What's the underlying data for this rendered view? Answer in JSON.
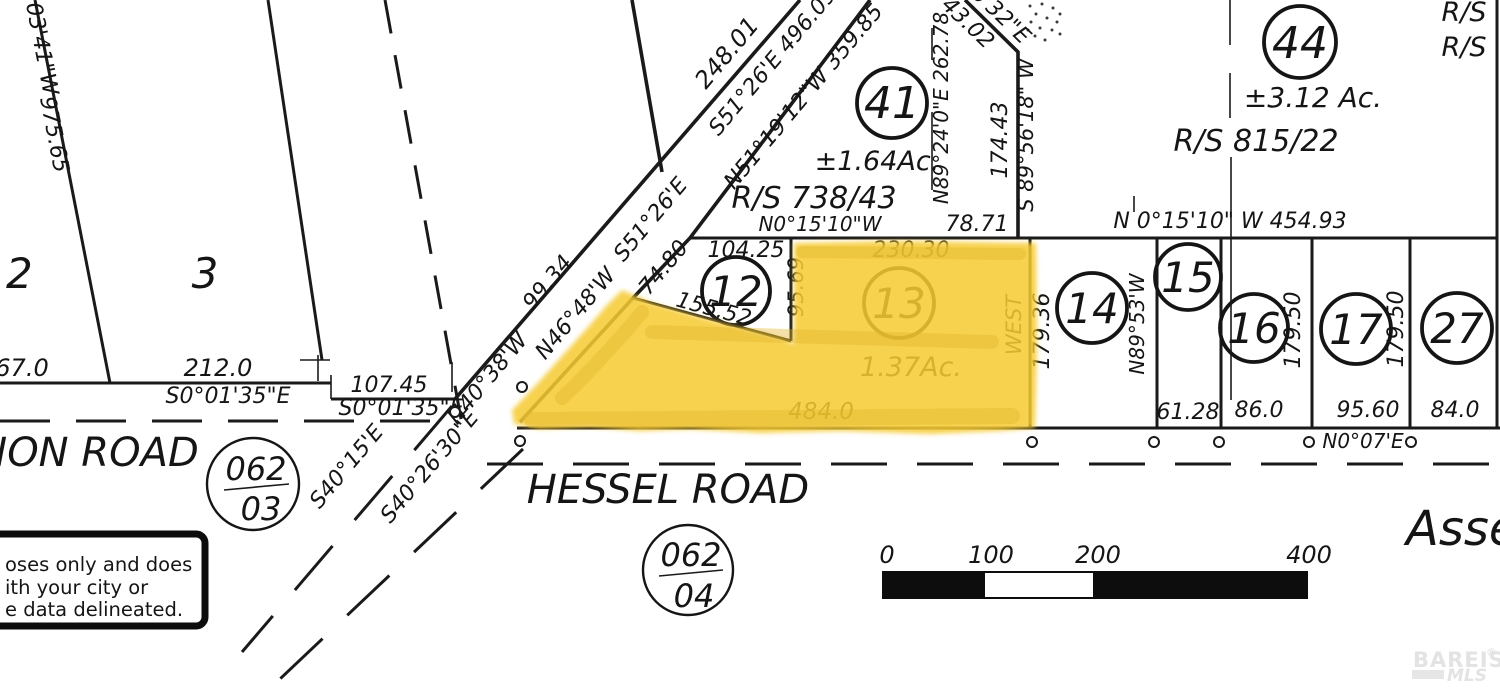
{
  "highlight": {
    "parcel": "13",
    "color": "#F6CB33",
    "streak_color": "#E2B62A"
  },
  "parcels": {
    "p2": "2",
    "p3": "3",
    "p12": "12",
    "p13": "13",
    "p14": "14",
    "p15": "15",
    "p16": "16",
    "p17": "17",
    "p27": "27",
    "p41": "41",
    "p44": "44"
  },
  "areas": {
    "a41": "±1.64Ac.",
    "a44": "±3.12  Ac.",
    "a13": "1.37Ac."
  },
  "survey_refs": {
    "rs41": "R/S  738/43",
    "rs44": "R/S  815/22",
    "rsTop1": "R/S",
    "rsTop2": "R/S"
  },
  "dimensions": {
    "d975_65": "975.65",
    "d67_0": "67.0",
    "d212_0": "212.0",
    "d107_45": "107.45",
    "d248_01": "248.01",
    "d99_34": "99.34",
    "d74_80": "74.80",
    "d104_25": "104.25",
    "d95_69": "95.69",
    "d155_52": "155.52",
    "d230_30": "230.30",
    "d484_0": "484.0",
    "d78_71": "78.71",
    "d43_02": "43.02",
    "d174_43": "174.43",
    "d179_36": "179.36",
    "d61_28": "61.28",
    "d86_0": "86.0",
    "d179_50a": "179.50",
    "d95_60": "95.60",
    "d179_50b": "179.50",
    "d84_0": "84.0"
  },
  "bearings": {
    "b0341": "03'41\"W",
    "bS001_35a": "S0°01'35\"E",
    "bS001_35b": "S0°01'35\"E",
    "bS51_26_496": "S51°26'E  496.09",
    "bN51_19": "N51°19'12\"W  359.85",
    "bS51_26": "S51°26'E",
    "bN46_48": "N46°48'W",
    "bN40_38": "N40°38'W",
    "bS40_15": "S40°15'E",
    "bS40_26": "S40°26'30\"E",
    "bN015_10": "N0°15'10\"W",
    "bN89_24": "N89°24'0\"E  262.78",
    "b6_32": "6'32\"E",
    "bS89_56": "S 89°56'18\" W",
    "bN015_454": "N  0°15'10\"  W  454.93",
    "bWEST": "WEST",
    "bN89_53": "N89°53'W",
    "bN0_07": "N0°07'E"
  },
  "roads": {
    "hessel": "HESSEL  ROAD",
    "non": "NON  ROAD"
  },
  "page_refs": {
    "c03_top": "062",
    "c03_bot": "03",
    "c04_top": "062",
    "c04_bot": "04"
  },
  "scale_bar": {
    "t0": "0",
    "t100": "100",
    "t200": "200",
    "t400": "400"
  },
  "disclaimer": {
    "line1": "oses  only  and  does",
    "line2": "ith  your  city  or",
    "line3": "e  data  delineated."
  },
  "corner_text": "Asse",
  "watermark": {
    "name": "BAREIS",
    "reg": "®",
    "sub": "MLS"
  }
}
